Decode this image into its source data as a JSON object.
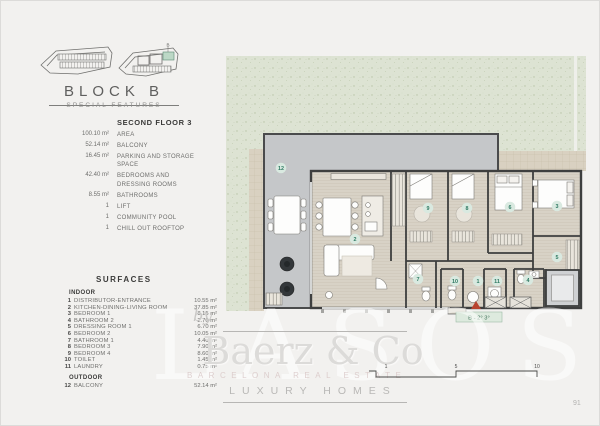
{
  "page": {
    "number": "91"
  },
  "site_overview": {
    "unit_label": "B"
  },
  "header": {
    "title": "BLOCK B",
    "subtitle": "SPECIAL FEATURES"
  },
  "features": {
    "title": "SECOND FLOOR 3",
    "items": [
      {
        "value": "100.10 m²",
        "label": "AREA"
      },
      {
        "value": "52.14 m²",
        "label": "BALCONY"
      },
      {
        "value": "16.45 m²",
        "label": "PARKING AND STORAGE SPACE"
      },
      {
        "value": "42.40 m²",
        "label": "BEDROOMS AND\nDRESSING ROOMS"
      },
      {
        "value": "8.55 m²",
        "label": "BATHROOMS"
      },
      {
        "value": "1",
        "label": "LIFT"
      },
      {
        "value": "1",
        "label": "COMMUNITY POOL"
      },
      {
        "value": "1",
        "label": "CHILL OUT ROOFTOP"
      }
    ]
  },
  "surfaces": {
    "title": "SURFACES",
    "indoor_label": "INDOOR",
    "outdoor_label": "OUTDOOR",
    "indoor": [
      {
        "num": "1",
        "name": "DISTRIBUTOR-ENTRANCE",
        "area": "10.55 m²"
      },
      {
        "num": "2",
        "name": "KITCHEN-DINING-LIVING ROOM",
        "area": "37.85 m²"
      },
      {
        "num": "3",
        "name": "BEDROOM 1",
        "area": "8.15 m²"
      },
      {
        "num": "4",
        "name": "BATHROOM 2",
        "area": "2.70 m²"
      },
      {
        "num": "5",
        "name": "DRESSING ROOM 1",
        "area": "6.70 m²"
      },
      {
        "num": "6",
        "name": "BEDROOM 2",
        "area": "10.05 m²"
      },
      {
        "num": "7",
        "name": "BATHROOM 1",
        "area": "4.40 m²"
      },
      {
        "num": "8",
        "name": "BEDROOM 3",
        "area": "7.90 m²"
      },
      {
        "num": "9",
        "name": "BEDROOM 4",
        "area": "8.60 m²"
      },
      {
        "num": "10",
        "name": "TOILET",
        "area": "1.45 m²"
      },
      {
        "num": "11",
        "name": "LAUNDRY",
        "area": "0.75 m²"
      }
    ],
    "outdoor": [
      {
        "num": "12",
        "name": "BALCONY",
        "area": "52.14 m²"
      }
    ]
  },
  "plan": {
    "entrance_label": "B - 2° 3°",
    "room_markers": [
      {
        "n": "12",
        "x": 55,
        "y": 112
      },
      {
        "n": "2",
        "x": 129,
        "y": 183
      },
      {
        "n": "9",
        "x": 202,
        "y": 152
      },
      {
        "n": "8",
        "x": 241,
        "y": 152
      },
      {
        "n": "6",
        "x": 284,
        "y": 151
      },
      {
        "n": "3",
        "x": 331,
        "y": 150
      },
      {
        "n": "5",
        "x": 331,
        "y": 201
      },
      {
        "n": "7",
        "x": 192,
        "y": 223
      },
      {
        "n": "10",
        "x": 229,
        "y": 225
      },
      {
        "n": "1",
        "x": 252,
        "y": 225
      },
      {
        "n": "11",
        "x": 271,
        "y": 225
      },
      {
        "n": "4",
        "x": 302,
        "y": 224
      }
    ],
    "scale_ticks": [
      {
        "label": "1",
        "x": 22
      },
      {
        "label": "5",
        "x": 92
      },
      {
        "label": "10",
        "x": 173
      }
    ]
  },
  "watermark": {
    "by": "by",
    "brand": "Baerz & Co",
    "tagline": "LUXURY HOMES",
    "ghost": "LASOSE",
    "subtext": "BARCELONA REAL ESTATE"
  },
  "colors": {
    "accent_green": "#2f7a63",
    "marker_bg": "#d9e9e0",
    "entrance_red": "#b8432f",
    "garden": "#dde3d3",
    "balcony": "#c5c7c9",
    "floor": "#d8d2c6",
    "wall": "#3e3f3f"
  }
}
